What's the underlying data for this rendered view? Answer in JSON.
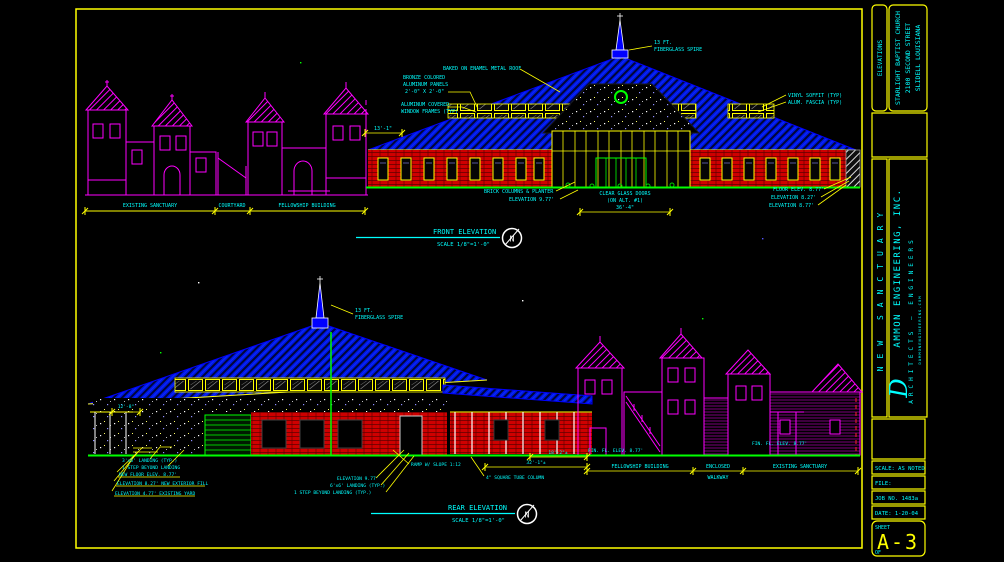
{
  "colors": {
    "background": "#000000",
    "border_yellow": "#ffff00",
    "text_cyan": "#00ffff",
    "roof_blue": "#0000ff",
    "wall_red": "#cf0000",
    "existing_magenta": "#ff00ff",
    "ground_green": "#00ff00",
    "accent_white": "#ffffff"
  },
  "titleblock": {
    "elevations_label": "ELEVATIONS",
    "client_line1": "STARLIGHT BAPTIST CHURCH",
    "client_line2": "2100 SECOND STREET",
    "client_line3": "SLIDELL LOUISIANA",
    "project": "NEW SANCTUARY",
    "firm_initial": "D",
    "firm_name": "AMMON ENGINEERING, INC.",
    "firm_type": "ARCHITECTS — ENGINEERS",
    "firm_web": "DAMMONENGINEERING.COM",
    "scale": "SCALE: AS NOTED",
    "file": "FILE:",
    "job": "JOB NO. 1483a",
    "date": "DATE: 1-20-04",
    "sheet_label": "SHEET",
    "sheet_number": "A-3",
    "of_label": "OF"
  },
  "overview": {
    "existing_sanctuary": "EXISTING SANCTUARY",
    "courtyard": "COURTYARD",
    "fellowship_building": "FELLOWSHIP BUILDING"
  },
  "front": {
    "title": "FRONT ELEVATION",
    "scale": "SCALE 1/8\"=1'-0\"",
    "north": "N",
    "spire_l1": "13 FT.",
    "spire_l2": "FIBERGLASS SPIRE",
    "roof_note": "BAKED ON ENAMEL METAL ROOF",
    "panels_l1": "BRONZE COLORED",
    "panels_l2": "ALUMINUM PANELS",
    "panels_l3": "2'-0\" X 2'-0\"",
    "frames_l1": "ALUMINUM COVERED",
    "frames_l2": "WINDOW FRAMES (TYP)",
    "dim_left": "13'-1\"",
    "soffit": "VINYL SOFFIT (TYP)",
    "fascia": "ALUM. FASCIA (TYP)",
    "brick_note": "BRICK COLUMNS & PLANTER",
    "brick_elev": "ELEVATION 9.77'",
    "doors_l1": "CLEAR GLASS DOORS",
    "doors_l2": "(ON ALT. #1)",
    "doors_dim": "36'-4\"",
    "floor_elev": "FLOOR ELEV. 8.77'",
    "elev_827": "ELEVATION 8.27'",
    "elev_877": "ELEVATION 8.77'"
  },
  "rear": {
    "title": "REAR ELEVATION",
    "scale": "SCALE 1/8\"=1'-0\"",
    "north": "N",
    "spire_l1": "13 FT.",
    "spire_l2": "FIBERGLASS SPIRE",
    "landing_a": "3'x6' LANDING (TYP.)",
    "step_a": "1 STEP BEYOND LANDING",
    "new_floor": "NEW FLOOR ELEV. 8.77'",
    "elev_fill": "ELEVATION 8.27' NEW EXTERIOR FILL",
    "elev_yard": "ELEVATION 4.77' EXISTING YARD",
    "dim_small": "12'-8\"",
    "elev_977": "ELEVATION 9.77'",
    "landing_b": "6'x6' LANDING (TYP.)",
    "step_b": "1 STEP BEYOND LANDING (TYP.)",
    "ramp": "RAMP W/ SLOPE 1:12",
    "column": "4\" SQUARE TUBE COLUMN",
    "dim_18": "18'-2\"±",
    "dim_32": "32'-1\"±",
    "fin_fl_a": "FIN. FL. ELEV. 8.77'",
    "fin_fl_b": "FIN. FL. ELEV. 8.77'",
    "fellowship": "FELLOWSHIP BUILDING",
    "enclosed_l1": "ENCLOSED",
    "enclosed_l2": "WALKWAY",
    "existing": "EXISTING SANCTUARY"
  }
}
